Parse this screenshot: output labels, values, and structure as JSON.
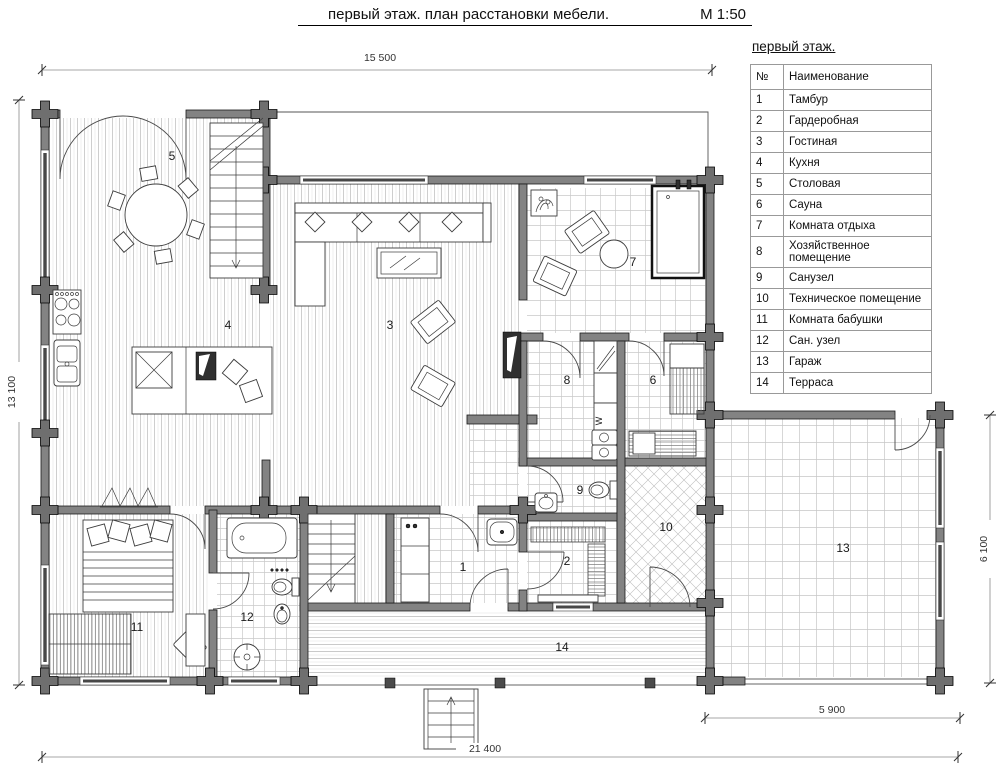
{
  "title": {
    "text": "первый этаж. план расстановки мебели.",
    "scale": "М 1:50"
  },
  "legend": {
    "header": "первый этаж.",
    "columns": [
      "№",
      "Наименование"
    ],
    "rooms": [
      {
        "num": "1",
        "name": "Тамбур"
      },
      {
        "num": "2",
        "name": "Гардеробная"
      },
      {
        "num": "3",
        "name": "Гостиная"
      },
      {
        "num": "4",
        "name": "Кухня"
      },
      {
        "num": "5",
        "name": "Столовая"
      },
      {
        "num": "6",
        "name": "Сауна"
      },
      {
        "num": "7",
        "name": "Комната отдыха"
      },
      {
        "num": "8",
        "name": "Хозяйственное помещение"
      },
      {
        "num": "9",
        "name": "Санузел"
      },
      {
        "num": "10",
        "name": "Техническое помещение"
      },
      {
        "num": "11",
        "name": "Комната бабушки"
      },
      {
        "num": "12",
        "name": "Сан. узел"
      },
      {
        "num": "13",
        "name": "Гараж"
      },
      {
        "num": "14",
        "name": "Терраса"
      }
    ]
  },
  "dimensions": {
    "top": "15 500",
    "left": "13 100",
    "right": "6 100",
    "bottom": "21 400",
    "bottom_right": "5 900"
  },
  "plan": {
    "washer_label": "W"
  }
}
